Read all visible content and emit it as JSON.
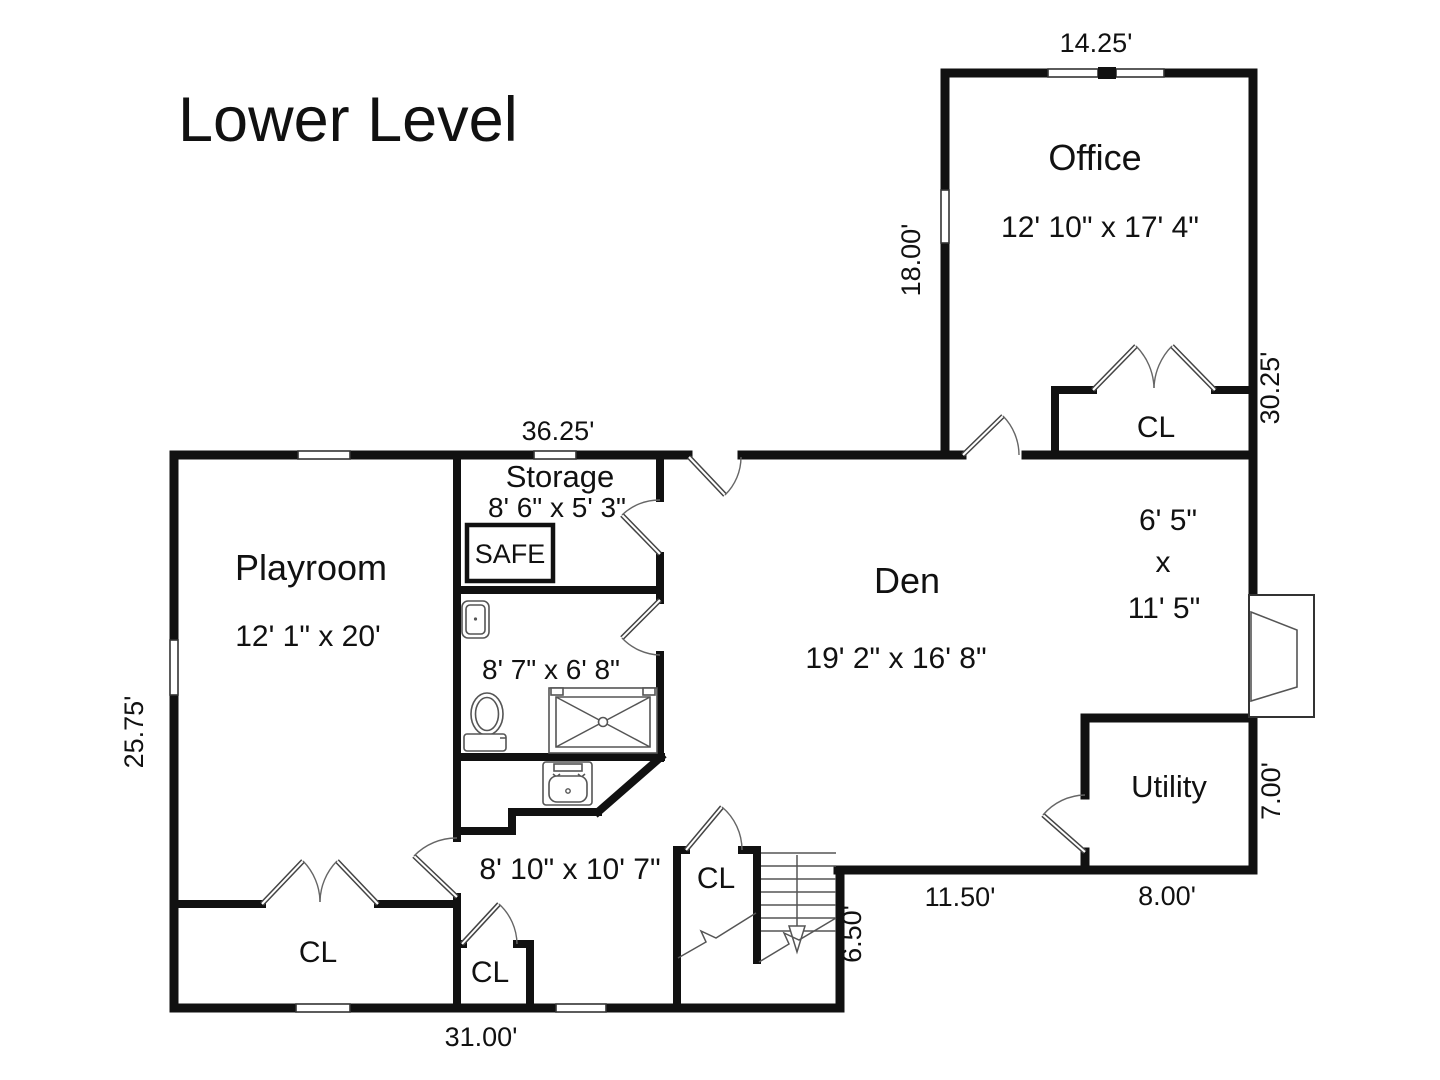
{
  "title": "Lower Level",
  "rooms": {
    "office": {
      "name": "Office",
      "dims": "12' 10\" x 17' 4\""
    },
    "den": {
      "name": "Den",
      "dims": "19' 2\" x 16' 8\""
    },
    "playroom": {
      "name": "Playroom",
      "dims": "12' 1\" x 20'"
    },
    "storage": {
      "name": "Storage",
      "dims": "8' 6\" x 5' 3\""
    },
    "bathroom": {
      "dims": "8' 7\" x 6' 8\""
    },
    "bonus_room": {
      "dims": "8' 10\" x 10' 7\""
    },
    "utility": {
      "name": "Utility"
    },
    "alcove": {
      "width": "6' 5\"",
      "sep": "x",
      "depth": "11' 5\""
    }
  },
  "closets": {
    "office_closet": "CL",
    "playroom_closet": "CL",
    "bonus_closet": "CL",
    "stair_closet": "CL"
  },
  "fixtures": {
    "safe": "SAFE"
  },
  "dimensions": {
    "office_top": "14.25'",
    "office_left": "18.00'",
    "right_upper": "30.25'",
    "main_top": "36.25'",
    "left_side": "25.75'",
    "bottom": "31.00'",
    "stairs_right": "6.50'",
    "den_bottom": "11.50'",
    "utility_bottom": "8.00'",
    "utility_right": "7.00'"
  }
}
